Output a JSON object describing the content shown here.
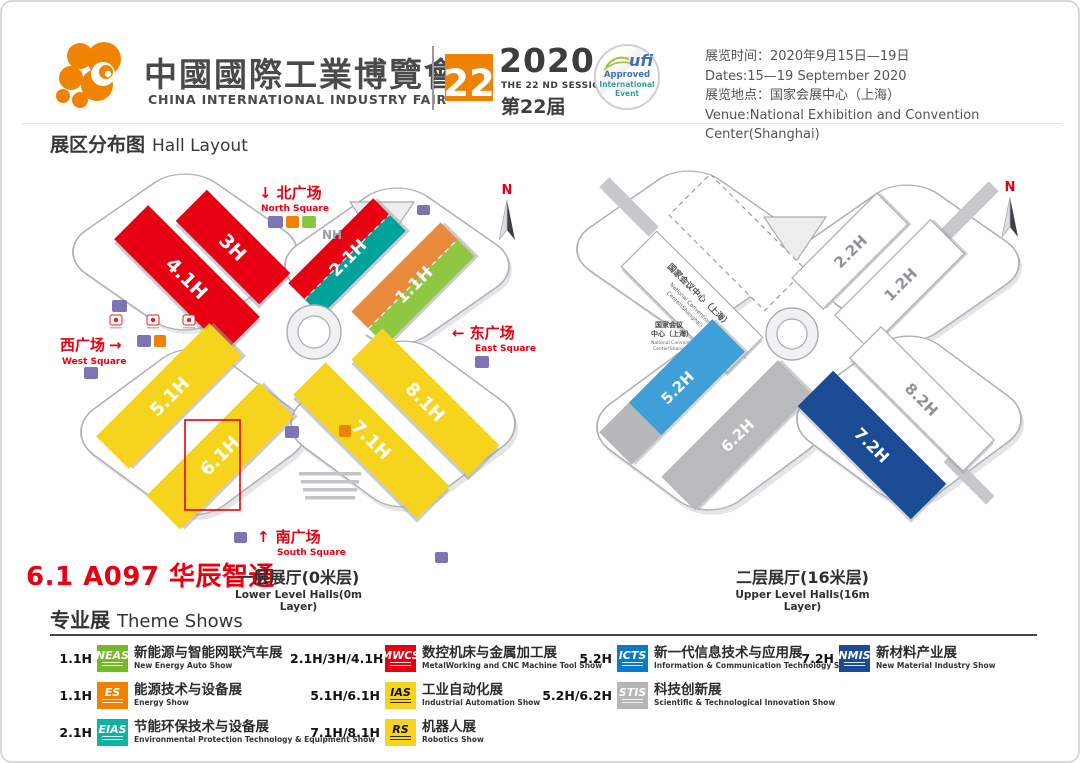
{
  "header": {
    "logo": {
      "title_zh": "中國國際工業博覽會",
      "title_en": "CHINA INTERNATIONAL INDUSTRY FAIR"
    },
    "session": {
      "number": "22",
      "year": "2020",
      "session_en": "THE 22 ND SESSION",
      "session_zh": "第22届"
    },
    "ufi": {
      "name": "ufi",
      "line1": "Approved",
      "line2": "International",
      "line3": "Event"
    },
    "info": {
      "time_zh": "展览时间：2020年9月15日—19日",
      "time_en": "Dates:15—19 September 2020",
      "venue_zh": "展览地点：国家会展中心（上海）",
      "venue_en": "Venue:National Exhibition and Convention Center(Shanghai)"
    }
  },
  "section": {
    "title_zh": "展区分布图",
    "title_en": "Hall Layout"
  },
  "booth_highlight": {
    "text": "6.1 A097 华辰智通",
    "color": "#e60012"
  },
  "maps": {
    "lower": {
      "caption_zh": "一层展厅(0米层)",
      "caption_en": "Lower Level Halls(0m Layer)",
      "nh": "NH",
      "compass": "N",
      "highlight_color": "#e60012",
      "squares": {
        "north": {
          "arrow": "↓",
          "zh": "北广场",
          "en": "North Square"
        },
        "west": {
          "zh": "西广场",
          "arrow": "→",
          "en": "West Square"
        },
        "east": {
          "arrow": "←",
          "zh": "东广场",
          "en": "East Square"
        },
        "south": {
          "arrow": "↑",
          "zh": "南广场",
          "en": "South Square"
        }
      },
      "halls": {
        "h3": {
          "id": "3H",
          "color": "#e60012"
        },
        "h41": {
          "id": "4.1H",
          "color": "#e60012"
        },
        "h21": {
          "id": "2.1H",
          "color_a": "#e60012",
          "color_b": "#00a29a"
        },
        "h11": {
          "id": "1.1H",
          "color_a": "#e9893c",
          "color_b": "#8fc742"
        },
        "h51": {
          "id": "5.1H",
          "color": "#f6d41d"
        },
        "h61": {
          "id": "6.1H",
          "color": "#f6d41d"
        },
        "h71": {
          "id": "7.1H",
          "color": "#f6d41d"
        },
        "h81": {
          "id": "8.1H",
          "color": "#f6d41d"
        }
      }
    },
    "upper": {
      "caption_zh": "二层展厅(16米层)",
      "caption_en": "Upper Level Halls(16m Layer)",
      "compass": "N",
      "ncc_band": {
        "zh": "国家会议中心（上海）",
        "en1": "National Convention",
        "en2": "Center(Shanghai)"
      },
      "ncc_small": {
        "zh1": "国家会议",
        "zh2": "中心（上海）",
        "en1": "National Convention",
        "en2": "Center(Shanghai)"
      },
      "halls": {
        "h22": {
          "id": "2.2H",
          "color": "#ffffff"
        },
        "h12": {
          "id": "1.2H",
          "color": "#ffffff"
        },
        "h52": {
          "id": "5.2H",
          "color": "#3f9fd8"
        },
        "h62": {
          "id": "6.2H",
          "color": "#b9babc"
        },
        "h72": {
          "id": "7.2H",
          "color": "#1a4b94"
        },
        "h82": {
          "id": "8.2H",
          "color": "#ffffff"
        }
      }
    }
  },
  "theme_shows": {
    "title_zh": "专业展",
    "title_en": "Theme Shows",
    "items": [
      {
        "halls": "1.1H",
        "logo": "NEAS",
        "logo_bg": "#76b82a",
        "logo_fg": "#ffffff",
        "zh": "新能源与智能网联汽车展",
        "en": "New Energy Auto Show"
      },
      {
        "halls": "1.1H",
        "logo": "ES",
        "logo_bg": "#ef8200",
        "logo_fg": "#ffffff",
        "zh": "能源技术与设备展",
        "en": "Energy Show"
      },
      {
        "halls": "2.1H",
        "logo": "EIAS",
        "logo_bg": "#10b2a2",
        "logo_fg": "#ffffff",
        "zh": "节能环保技术与设备展",
        "en": "Environmental Protection Technology & Equipment Show"
      },
      {
        "halls": "2.1H/3H/4.1H",
        "logo": "MWCS",
        "logo_bg": "#e60012",
        "logo_fg": "#ffffff",
        "zh": "数控机床与金属加工展",
        "en": "MetalWorking and CNC Machine Tool Show"
      },
      {
        "halls": "5.1H/6.1H",
        "logo": "IAS",
        "logo_bg": "#f6d41d",
        "logo_fg": "#111111",
        "zh": "工业自动化展",
        "en": "Industrial Automation Show"
      },
      {
        "halls": "7.1H/8.1H",
        "logo": "RS",
        "logo_bg": "#f6d41d",
        "logo_fg": "#111111",
        "zh": "机器人展",
        "en": "Robotics Show"
      },
      {
        "halls": "5.2H",
        "logo": "ICTS",
        "logo_bg": "#0a7bc4",
        "logo_fg": "#ffffff",
        "zh": "新一代信息技术与应用展",
        "en": "Information & Communication Technology Show"
      },
      {
        "halls": "5.2H/6.2H",
        "logo": "STIS",
        "logo_bg": "#b5b6b8",
        "logo_fg": "#ffffff",
        "zh": "科技创新展",
        "en": "Scientific & Technological Innovation Show"
      },
      {
        "halls": "7.2H",
        "logo": "NMIS",
        "logo_bg": "#1a4b94",
        "logo_fg": "#ffffff",
        "zh": "新材料产业展",
        "en": "New Material Industry Show"
      }
    ]
  }
}
